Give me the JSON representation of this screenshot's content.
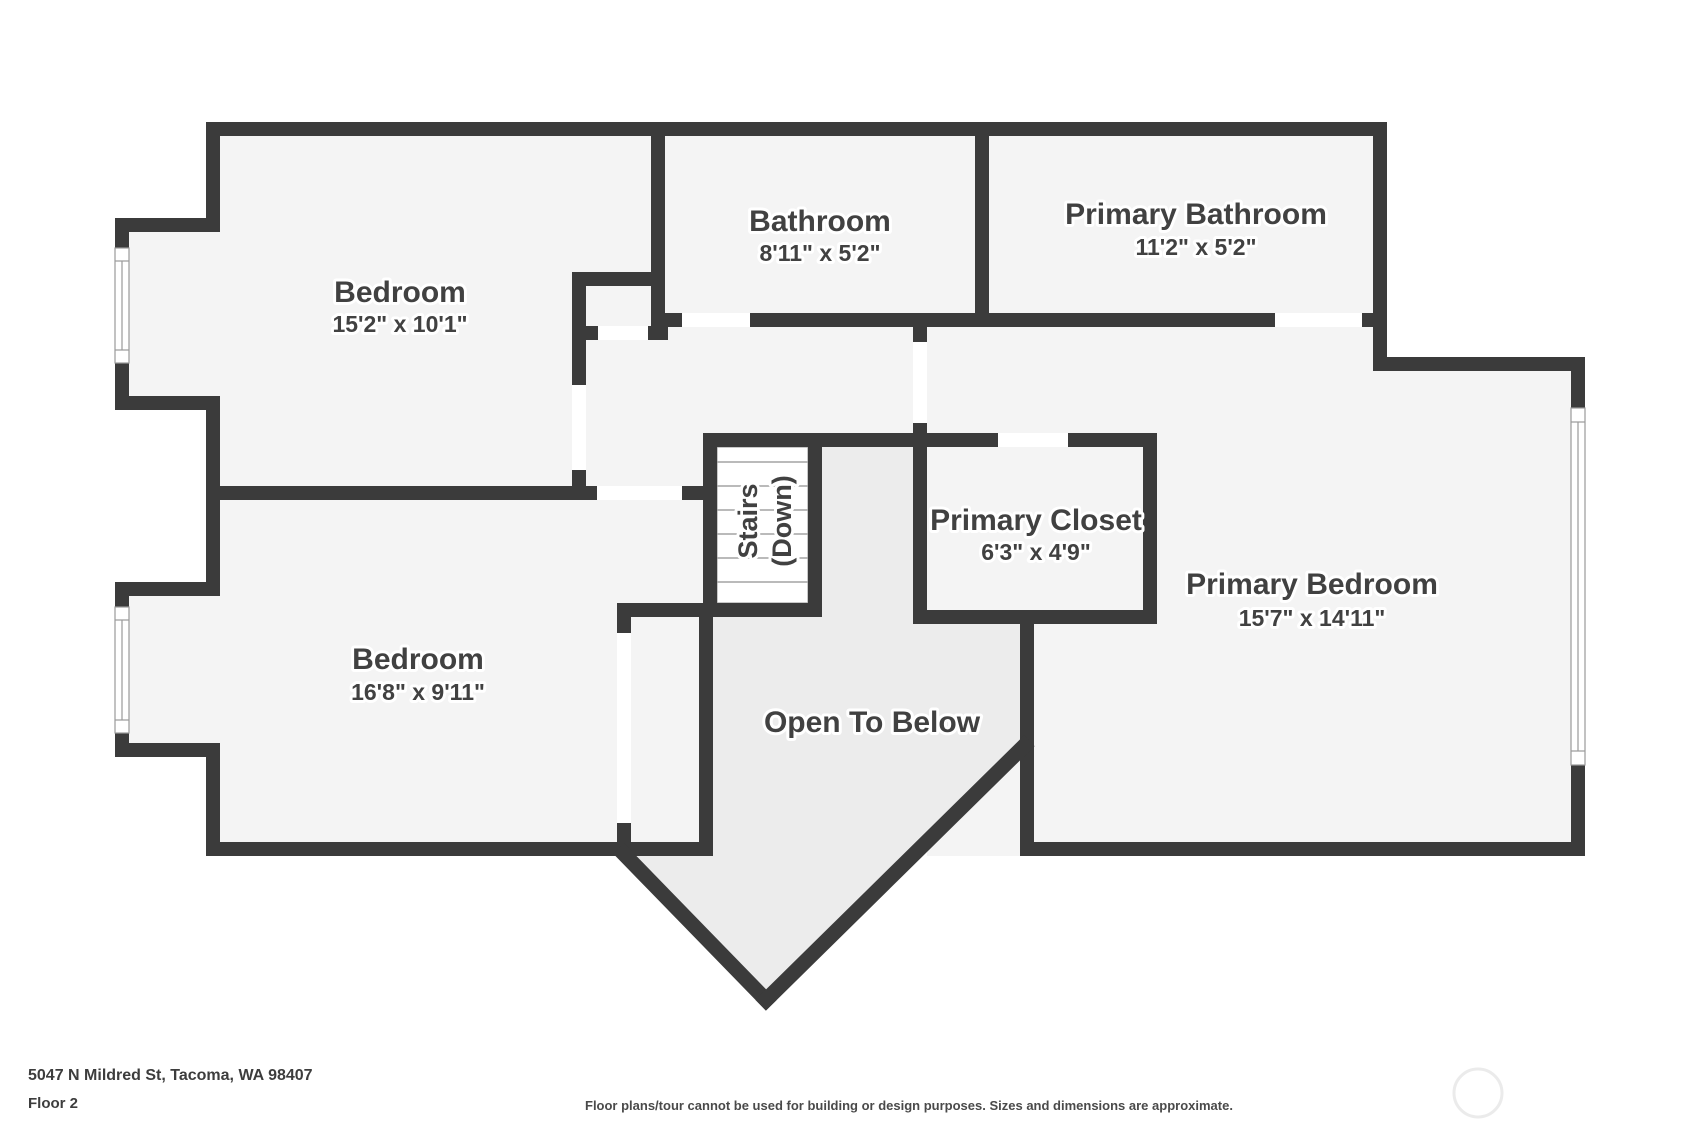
{
  "plan": {
    "rooms": [
      {
        "name": "Bedroom",
        "dims": "15'2\" x 10'1\""
      },
      {
        "name": "Bathroom",
        "dims": "8'11\" x 5'2\""
      },
      {
        "name": "Primary Bathroom",
        "dims": "11'2\" x 5'2\""
      },
      {
        "name": "Primary Closet",
        "dims": "6'3\" x 4'9\""
      },
      {
        "name": "Primary Bedroom",
        "dims": "15'7\" x 14'11\""
      },
      {
        "name": "Bedroom",
        "dims": "16'8\" x 9'11\""
      }
    ],
    "stairs": {
      "line1": "Stairs",
      "line2": "(Down)"
    },
    "open_to_below": "Open To Below"
  },
  "footer": {
    "address": "5047 N Mildred St, Tacoma, WA 98407",
    "floor": "Floor 2",
    "disclaimer": "Floor plans/tour cannot be used for building or design purposes. Sizes and dimensions are approximate."
  },
  "colors": {
    "wall": "#3b3b3b",
    "floor": "#f4f4f4",
    "open_to_below_floor": "#ececec",
    "label_text": "#414141",
    "background": "#ffffff"
  }
}
